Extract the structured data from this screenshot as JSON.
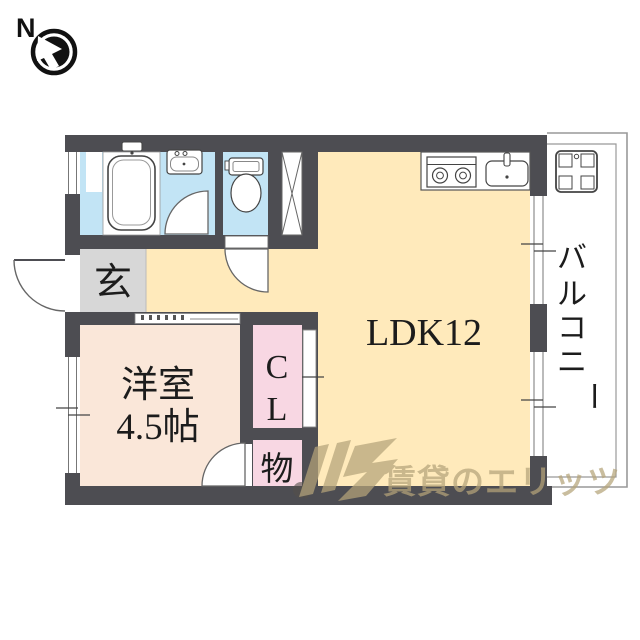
{
  "compass": {
    "label": "N"
  },
  "plan": {
    "entrance_label": "玄",
    "western_room_line1": "洋室",
    "western_room_line2": "4.5帖",
    "closet_char_top": "C",
    "closet_char_bottom": "L",
    "storage_label": "物",
    "ldk_label": "LDK12",
    "balcony_label": "バルコニー",
    "balcony_chars": [
      "バ",
      "ル",
      "コ",
      "ニ",
      "ー"
    ]
  },
  "fixtures": {
    "icons": [
      "bathtub-icon",
      "washbasin-icon",
      "toilet-icon",
      "pipe-shaft-icon",
      "stove-icon",
      "kitchen-sink-icon",
      "washer-pan-icon",
      "door-arc",
      "window-symbol",
      "compass-icon"
    ]
  },
  "watermark": {
    "text": "賃貸のエリッツ"
  },
  "colors": {
    "wall": "#4d4d52",
    "wet_room": "#c2e4f5",
    "ldk": "#ffeabb",
    "western_room": "#fae7d9",
    "closet": "#f8d7e3",
    "entrance": "#d7d7d7",
    "fixture_outline": "#444444",
    "balcony_line": "#999999",
    "watermark_color": "#b5a47a"
  }
}
